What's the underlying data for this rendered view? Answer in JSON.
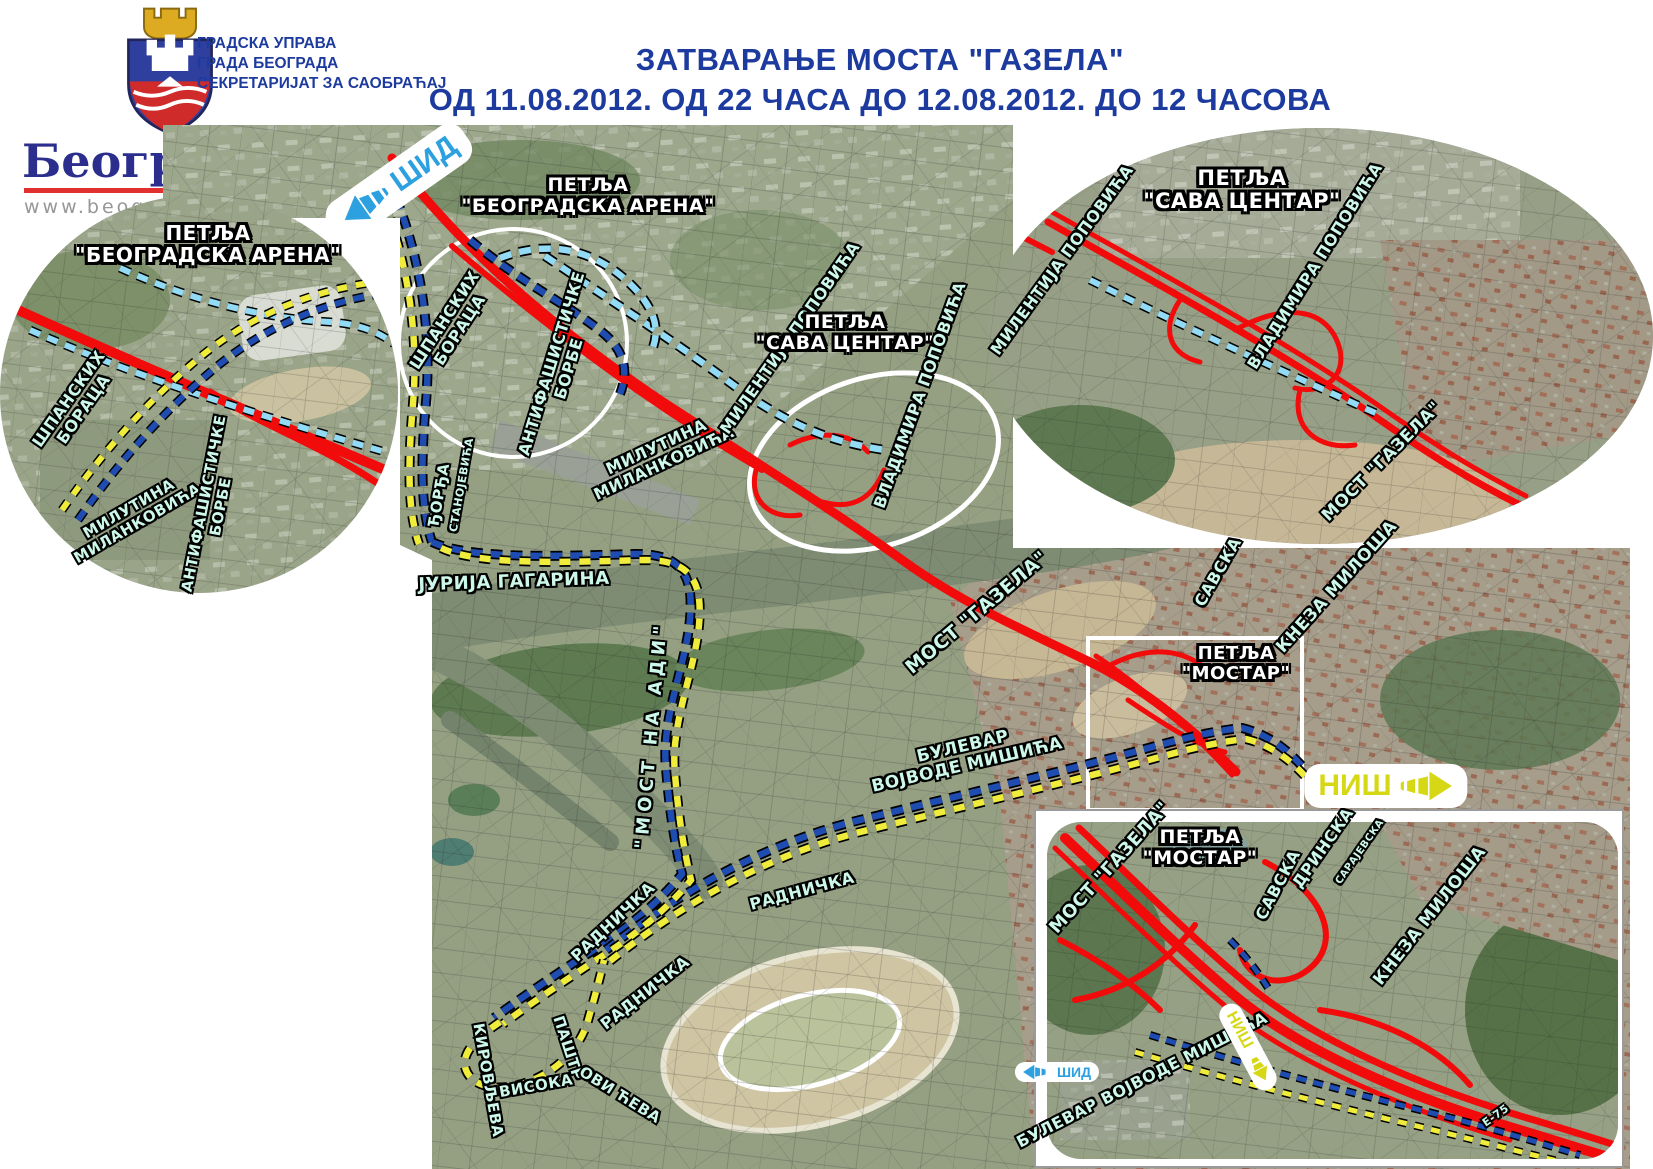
{
  "header": {
    "agency": "ГРАДСКА УПРАВА\nГРАДА БЕОГРАДА\nСЕКРЕТАРИЈАТ ЗА САОБРАЋАЈ",
    "title_line1": "ЗАТВАРАЊЕ МОСТА \"ГАЗЕЛА\"",
    "title_line2": "ОД 11.08.2012. ОД 22 ЧАСА ДО 12.08.2012. ДО 12 ЧАСОВА",
    "accent_color": "#1d3b9e",
    "logo": {
      "icon": "belgrade-coat-of-arms",
      "city": "Београд",
      "website": "www.beograd.rs"
    }
  },
  "legend": {
    "title": "ЛЕГЕНДА",
    "closed_label": "Затворено за саобраћај",
    "closed_color": "#f10b0b",
    "alt_title": "АЛТЕРНАТИВНЕ ТРАСЕ",
    "routes": [
      {
        "label": "Смер од Ниша ка Шиду",
        "color": "#1e4cb0"
      },
      {
        "label": "Смер од Шида ка Нишу",
        "color": "#efec3c"
      },
      {
        "label": "Смер од Новог Београда\nка Шиду",
        "color": "#93dbf5"
      }
    ]
  },
  "map": {
    "signs": {
      "sid": "ШИД",
      "nis": "НИШ"
    },
    "labels": {
      "petlja_arena": "ПЕТЉА\n\"БЕОГРАДСКА АРЕНА\"",
      "petlja_sava": "ПЕТЉА\n\"САВА ЦЕНТАР\"",
      "petlja_mostar": "ПЕТЉА\n\"МОСТАР\"",
      "most_gazela": "МОСТ \"ГАЗЕЛА\"",
      "most_na_adi": "\"МОСТ  НА  АДИ\"",
      "spanskih": "ШПАНСКИХ\nБОРАЦА",
      "antifasisticke": "АНТИФАШИСТИЧКЕ\nБОРБЕ",
      "milutina": "МИЛУТИНА\nМИЛАНКОВИЋА",
      "milentija": "МИЛЕНТИЈА ПОПОВИЋА",
      "vladimira": "ВЛАДИМИРА ПОПОВИЋА",
      "djordja": "ЂОРЂА",
      "stanojevica": "СТАНОЈЕВИЋА",
      "jurija": "ЈУРИЈА ГАГАРИНА",
      "savska": "САВСКА",
      "kneza": "КНЕЗА МИЛОША",
      "bulevar_two": "БУЛЕВАР\nВОЈВОДЕ МИШИЋА",
      "bulevar_one": "БУЛЕВАР ВОЈВОДЕ МИШИЋА",
      "radnicka": "РАДНИЧКА",
      "pastrovica_a": "ПАШТР",
      "pastrovica_b": "ОВИ ЋЕВА",
      "visoka": "ВИСОКА",
      "kirovljeva": "КИРОВЉЕВА",
      "drinska": "ДРИНСКА",
      "sarajevska": "САРАЈЕВСКА",
      "e75": "Е-75"
    }
  },
  "footer": {
    "department": "Одељење за информисање и информационе технологије"
  }
}
